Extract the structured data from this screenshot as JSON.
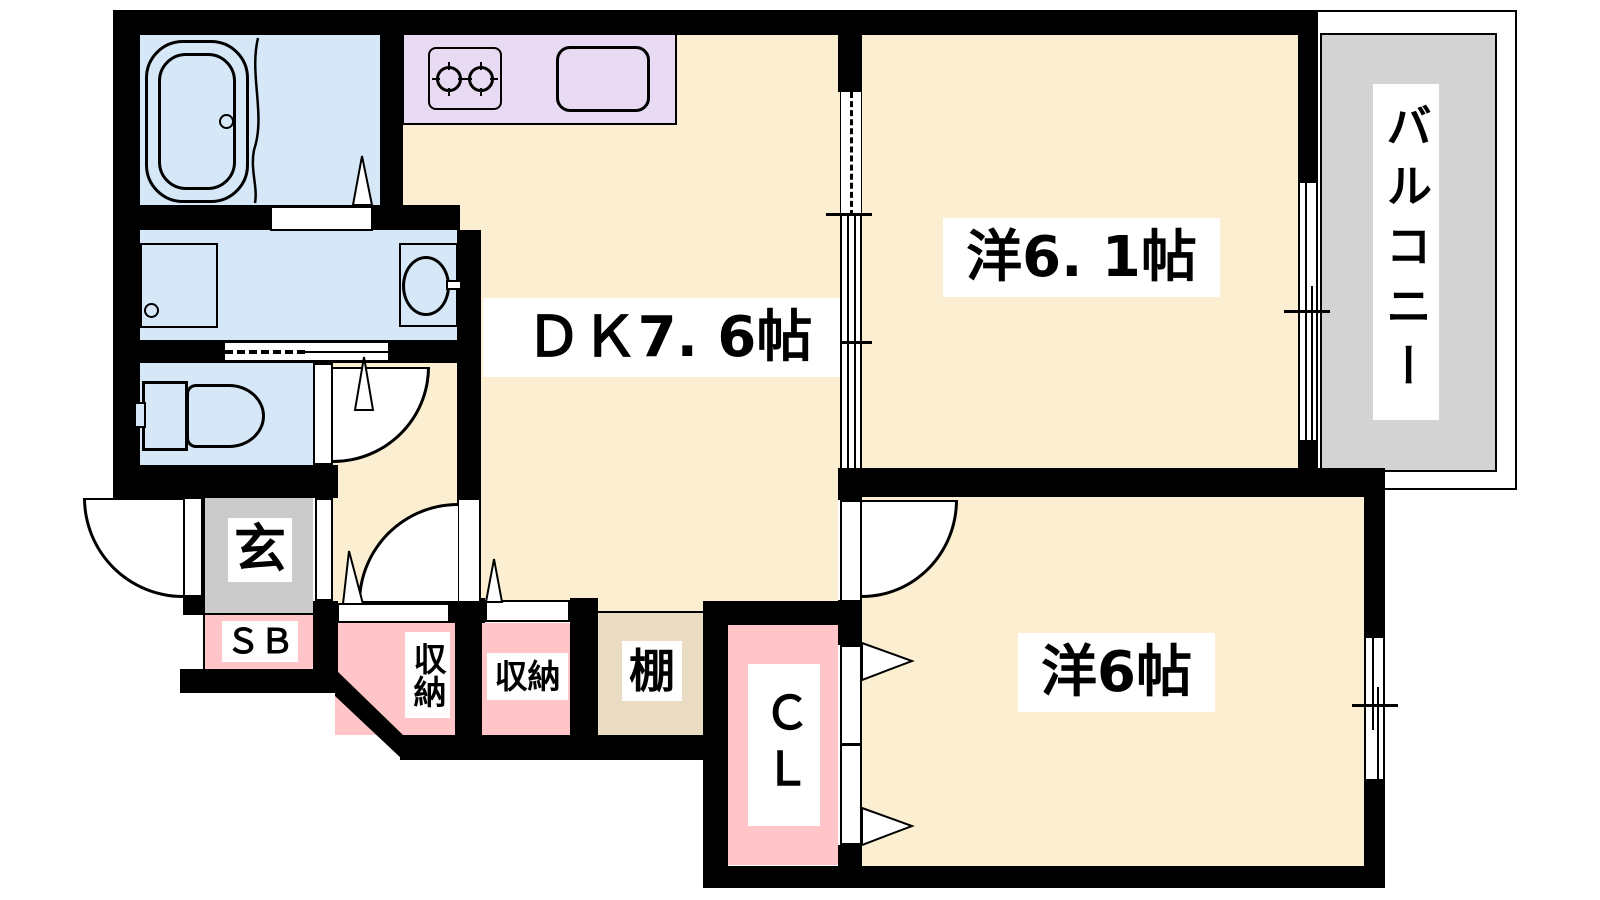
{
  "labels": {
    "dk": "ＤＫ7. 6帖",
    "western_6_1": "洋6. 1帖",
    "western_6": "洋6帖",
    "balcony": "バルコニー",
    "entrance": "玄",
    "shoe_box": "ＳＢ",
    "storage_left": "収納",
    "storage_right": "収納",
    "shelf": "棚",
    "closet": "ＣＬ"
  },
  "colors": {
    "wall": "#000000",
    "line": "#000000",
    "cream": "#FCEFD1",
    "blue": "#D6E8F8",
    "lavender": "#E8DAF2",
    "pink": "#FFC5C9",
    "gray": "#CBCBCB",
    "balcony": "#D3D3D3",
    "beige": "#E9DCC3",
    "labelbg": "#FFFFFF"
  }
}
